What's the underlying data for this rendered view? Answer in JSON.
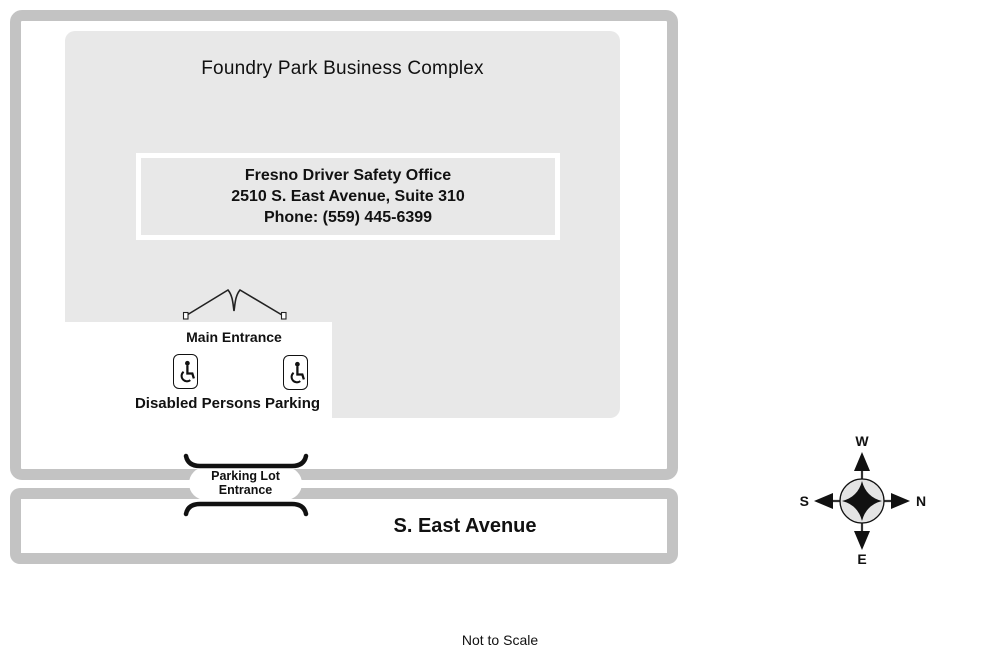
{
  "map": {
    "complex_name": "Foundry Park Business Complex",
    "office": {
      "name": "Fresno Driver Safety Office",
      "address": "2510 S. East Avenue, Suite 310",
      "phone": "Phone: (559) 445-6399"
    },
    "labels": {
      "main_entrance": "Main Entrance",
      "disabled_parking": "Disabled Persons Parking",
      "lot_entrance_line1": "Parking Lot",
      "lot_entrance_line2": "Entrance",
      "street": "S. East Avenue",
      "scale_note": "Not to Scale"
    },
    "compass": {
      "top": "W",
      "right": "N",
      "left": "S",
      "bottom": "E"
    },
    "icons": {
      "disabled_parking_left": "wheelchair-icon",
      "disabled_parking_right": "wheelchair-icon"
    },
    "colors": {
      "road_border_gray": "#c3c3c3",
      "building_fill_gray": "#e8e8e8",
      "ink_black": "#111111",
      "compass_circle_fill": "#e4e4e4"
    }
  }
}
